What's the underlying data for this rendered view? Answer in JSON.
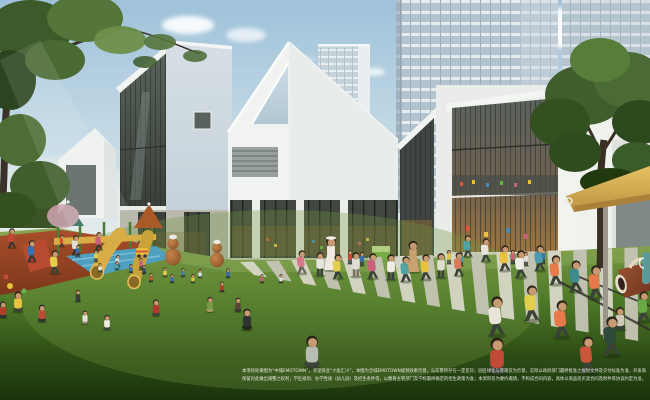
{
  "scene": {
    "alt": "Architectural rendering of a kindergarten courtyard: white gabled buildings, high-rise towers behind, children playing on a lawn"
  },
  "caption": {
    "line1": "本项目效果图为“中城EMOTOWN”，邻里商业“小鱼汇川”，本图为全域EMOTOWN规划效果示意，与实景将存在一定差异；园区绿化与景观仅为示意，实际以政府部门最终批准之规划文件及交付标准为准，开发商",
    "line2": "保留对此做出调整之权利；学区规划、办学性质（幼儿园）及招生条件等，以教育主管部门及学校最终确定的招生政策为准；本资料仅为要约邀请，不构成合同内容，具体以商品房买卖合同及附件等协议约定为准。"
  },
  "palette": {
    "sky_top": "#9fc2da",
    "sky_horizon": "#eef0ec",
    "building_white": "#f1f3f0",
    "building_shade": "#e2e7e7",
    "glass_dark": "#434a44",
    "glass_warm": "#9a7440",
    "tower_glass": "#b3c4d0",
    "lawn_light": "#85a04c",
    "lawn_dark": "#1b340c",
    "playground_red": "#a84e2a",
    "slide_yellow": "#d9ad45",
    "pool_blue": "#4f9fc0",
    "canopy_yellow": "#d9b659",
    "gourd_brown": "#9a5c30",
    "tree_green": "#3f5e2c",
    "caption_color": "#f7f7f2"
  },
  "paving": {
    "count": 16,
    "top": [
      [
        240,
        262
      ],
      [
        650,
        247
      ]
    ],
    "bottom": [
      [
        254,
        275
      ],
      [
        650,
        343
      ]
    ],
    "stripe": "#d8d7c7",
    "stripe_alt": "#c6c5b5"
  },
  "figures": [
    [
      331,
      270,
      34,
      "dress",
      "#efe9e0",
      "#efe9e0",
      1
    ],
    [
      413,
      272,
      32,
      "dress",
      "#c9a070",
      "#8a4a38",
      0
    ],
    [
      100,
      272,
      11,
      "sit",
      "#e8e6de",
      "#3a4238"
    ],
    [
      117,
      270,
      11,
      "sit",
      "#4fa3a0",
      "#3a4238"
    ],
    [
      131,
      273,
      11,
      "sit",
      "#3a6fae",
      "#2e3430"
    ],
    [
      144,
      274,
      11,
      "sit",
      "#2b4a6e",
      "#2e3430"
    ],
    [
      165,
      277,
      12,
      "sit",
      "#e3cf4b",
      "#4a4436"
    ],
    [
      183,
      277,
      11,
      "sit",
      "#4a7ab8",
      "#2e3430"
    ],
    [
      200,
      278,
      11,
      "sit",
      "#dbe2e6",
      "#3a4238"
    ],
    [
      228,
      278,
      12,
      "sit",
      "#3a67b0",
      "#2e3430"
    ],
    [
      222,
      292,
      13,
      "sit",
      "#b0402a",
      "#2e3430"
    ],
    [
      78,
      302,
      15,
      "sit",
      "#3a3f35",
      "#2e3430"
    ],
    [
      85,
      324,
      17,
      "sit",
      "#e6e3da",
      "#8a8478"
    ],
    [
      107,
      330,
      19,
      "sit",
      "#efeee6",
      "#3a4238"
    ],
    [
      156,
      316,
      21,
      "sit",
      "#b03a2e",
      "#3a4238"
    ],
    [
      210,
      312,
      19,
      "sit",
      "#7a9a4a",
      "#b09a6a"
    ],
    [
      238,
      312,
      18,
      "sit",
      "#5a4434",
      "#3a3430"
    ],
    [
      151,
      282,
      11,
      "sit",
      "#c94f38",
      "#2e3430"
    ],
    [
      172,
      283,
      11,
      "sit",
      "#3f6db5",
      "#2e3430"
    ],
    [
      193,
      283,
      11,
      "sit",
      "#d8c84a",
      "#2e3430"
    ],
    [
      262,
      283,
      11,
      "sit",
      "#c9607a",
      "#2e3430"
    ],
    [
      281,
      283,
      11,
      "sit",
      "#e0ded4",
      "#2e3430"
    ],
    [
      247,
      330,
      27,
      "sit",
      "#2e3430",
      "#23281f"
    ],
    [
      312,
      368,
      41,
      "sit",
      "#b9bcb4",
      "#3a4238"
    ],
    [
      497,
      374,
      46,
      "sit",
      "#c04a35",
      "#3a4238"
    ],
    [
      620,
      330,
      29,
      "sit",
      "#cfc9b8",
      "#3a4238"
    ],
    [
      644,
      322,
      31,
      "run",
      "#6aa845",
      "#3a4238"
    ],
    [
      12,
      248,
      20,
      "run",
      "#c04a35",
      "#2e3430"
    ],
    [
      32,
      262,
      22,
      "run",
      "#3a6fae",
      "#2e3430"
    ],
    [
      55,
      274,
      24,
      "run",
      "#e3cf4b",
      "#3a4238"
    ],
    [
      76,
      255,
      20,
      "run",
      "#e0ded4",
      "#2e3430"
    ],
    [
      99,
      250,
      18,
      "run",
      "#c9607a",
      "#2e3430"
    ],
    [
      18,
      312,
      26,
      "sit",
      "#e8c23f",
      "#3a4238"
    ],
    [
      42,
      322,
      22,
      "sit",
      "#c04a35",
      "#2e3430"
    ],
    [
      3,
      318,
      21,
      "sit",
      "#b0402a",
      "#2e3430"
    ],
    [
      62,
      247,
      12,
      "run",
      "#d84a30",
      "#2e3430"
    ],
    [
      78,
      257,
      12,
      "run",
      "#3a67b0",
      "#2e3430"
    ],
    [
      96,
      262,
      12,
      "stand",
      "#e3cf4b",
      "#2e3430"
    ],
    [
      118,
      267,
      12,
      "run",
      "#e0ded4",
      "#2e3430"
    ],
    [
      141,
      270,
      12,
      "stand",
      "#c9607a",
      "#2e3430"
    ],
    [
      302,
      274,
      24,
      "run",
      "#d87a8a",
      "#6a6258"
    ],
    [
      320,
      276,
      24,
      "stand",
      "#e8e6e0",
      "#3a4238"
    ],
    [
      338,
      279,
      25,
      "run",
      "#e3cf4b",
      "#3a4238"
    ],
    [
      356,
      277,
      25,
      "stand",
      "#e0ddd4",
      "#7a7268"
    ],
    [
      373,
      279,
      26,
      "run",
      "#c9607a",
      "#3a4238"
    ],
    [
      391,
      280,
      26,
      "stand",
      "#efeee6",
      "#3a4238"
    ],
    [
      406,
      282,
      26,
      "run",
      "#4fa3a0",
      "#3a4238"
    ],
    [
      426,
      280,
      26,
      "run",
      "#e8c23f",
      "#3a4238"
    ],
    [
      441,
      278,
      25,
      "stand",
      "#e0ded4",
      "#3a4238"
    ],
    [
      459,
      276,
      24,
      "run",
      "#d87a5a",
      "#3a4238"
    ],
    [
      350,
      264,
      14,
      "stand",
      "#c04a35",
      "#2e3430"
    ],
    [
      362,
      266,
      14,
      "stand",
      "#3a6fae",
      "#2e3430"
    ],
    [
      449,
      264,
      14,
      "stand",
      "#d8c84a",
      "#2e3430"
    ],
    [
      461,
      266,
      14,
      "stand",
      "#4aa0a0",
      "#2e3430"
    ],
    [
      513,
      264,
      14,
      "stand",
      "#c9607a",
      "#2e3430"
    ],
    [
      526,
      266,
      14,
      "stand",
      "#e0ded4",
      "#2e3430"
    ],
    [
      543,
      264,
      15,
      "stand",
      "#3a6fae",
      "#2e3430"
    ],
    [
      468,
      257,
      22,
      "run",
      "#4fa3a0",
      "#3a4238"
    ],
    [
      486,
      262,
      24,
      "run",
      "#e8e2d8",
      "#3a4238"
    ],
    [
      505,
      271,
      26,
      "run",
      "#e8c23f",
      "#3a4238"
    ],
    [
      521,
      278,
      28,
      "run",
      "#efece4",
      "#3a4238"
    ],
    [
      540,
      271,
      26,
      "run",
      "#4a9ab0",
      "#3a4238"
    ],
    [
      556,
      285,
      30,
      "run",
      "#e87a4a",
      "#3a4238"
    ],
    [
      576,
      292,
      32,
      "run",
      "#3f8a8a",
      "#3a4238"
    ],
    [
      596,
      299,
      34,
      "run",
      "#e87a4a",
      "#3a4238"
    ],
    [
      532,
      321,
      36,
      "run",
      "#e3cf4b",
      "#3a4238"
    ],
    [
      497,
      336,
      40,
      "run",
      "#e8e4da",
      "#3a4238"
    ],
    [
      562,
      338,
      38,
      "run",
      "#e87a4a",
      "#3a4238"
    ],
    [
      612,
      356,
      40,
      "run",
      "#2e4a3a",
      "#3a4238"
    ],
    [
      588,
      374,
      38,
      "run",
      "#c9553a",
      "#3a4238"
    ]
  ]
}
